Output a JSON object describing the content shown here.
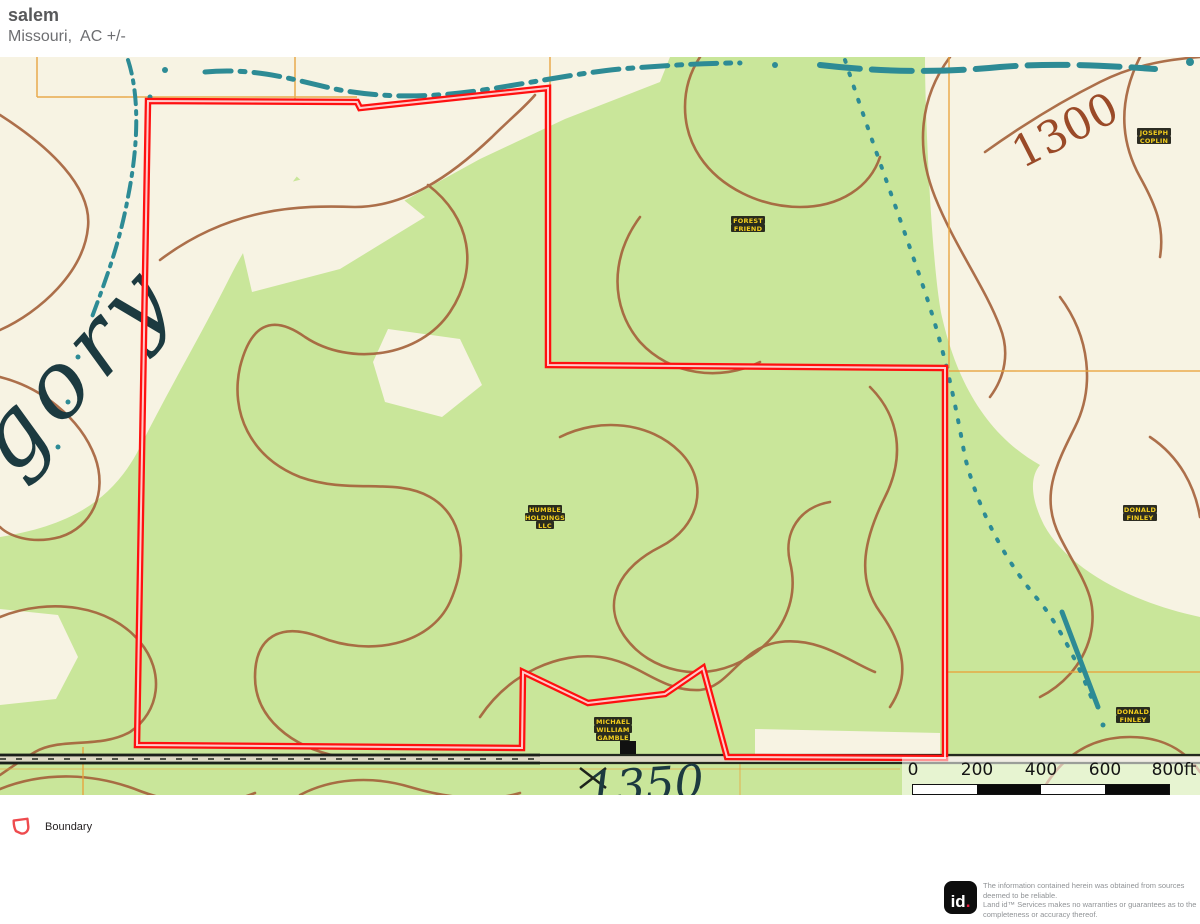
{
  "header": {
    "title": "salem",
    "subtitle": "Missouri,  AC +/-"
  },
  "map": {
    "place_label": "gory",
    "elevation_labels": {
      "upper": "1300",
      "lower": "1350"
    },
    "owner_labels": [
      {
        "name": "joseph-coplin",
        "lines": [
          "JOSEPH",
          "COPLIN"
        ]
      },
      {
        "name": "forest-friend",
        "lines": [
          "FOREST",
          "FRIEND"
        ]
      },
      {
        "name": "humble-holdings",
        "lines": [
          "HUMBLE",
          "HOLDINGS",
          "LLC"
        ]
      },
      {
        "name": "donald-finley-1",
        "lines": [
          "DONALD",
          "FINLEY"
        ]
      },
      {
        "name": "donald-finley-2",
        "lines": [
          "DONALD",
          "FINLEY"
        ]
      },
      {
        "name": "michael-gamble",
        "lines": [
          "MICHAEL",
          "WILLIAM",
          "GAMBLE"
        ]
      }
    ],
    "colors": {
      "boundary": "#ff1010",
      "vegetation": "#c9e69a",
      "open_land": "#f7f3e3",
      "contour": "#a4613a",
      "water": "#2d8b95",
      "section_line": "#e8a33d"
    }
  },
  "scalebar": {
    "labels": [
      "0",
      "200",
      "400",
      "600",
      "800ft"
    ]
  },
  "legend": {
    "items": [
      {
        "label": "Boundary"
      }
    ]
  },
  "footer": {
    "logo_text": "id",
    "logo_dot": ".",
    "disclaimer": "The information contained herein was obtained from sources\ndeemed to be reliable.\n Land id™ Services makes no warranties or guarantees as to the\ncompleteness or accuracy thereof."
  }
}
